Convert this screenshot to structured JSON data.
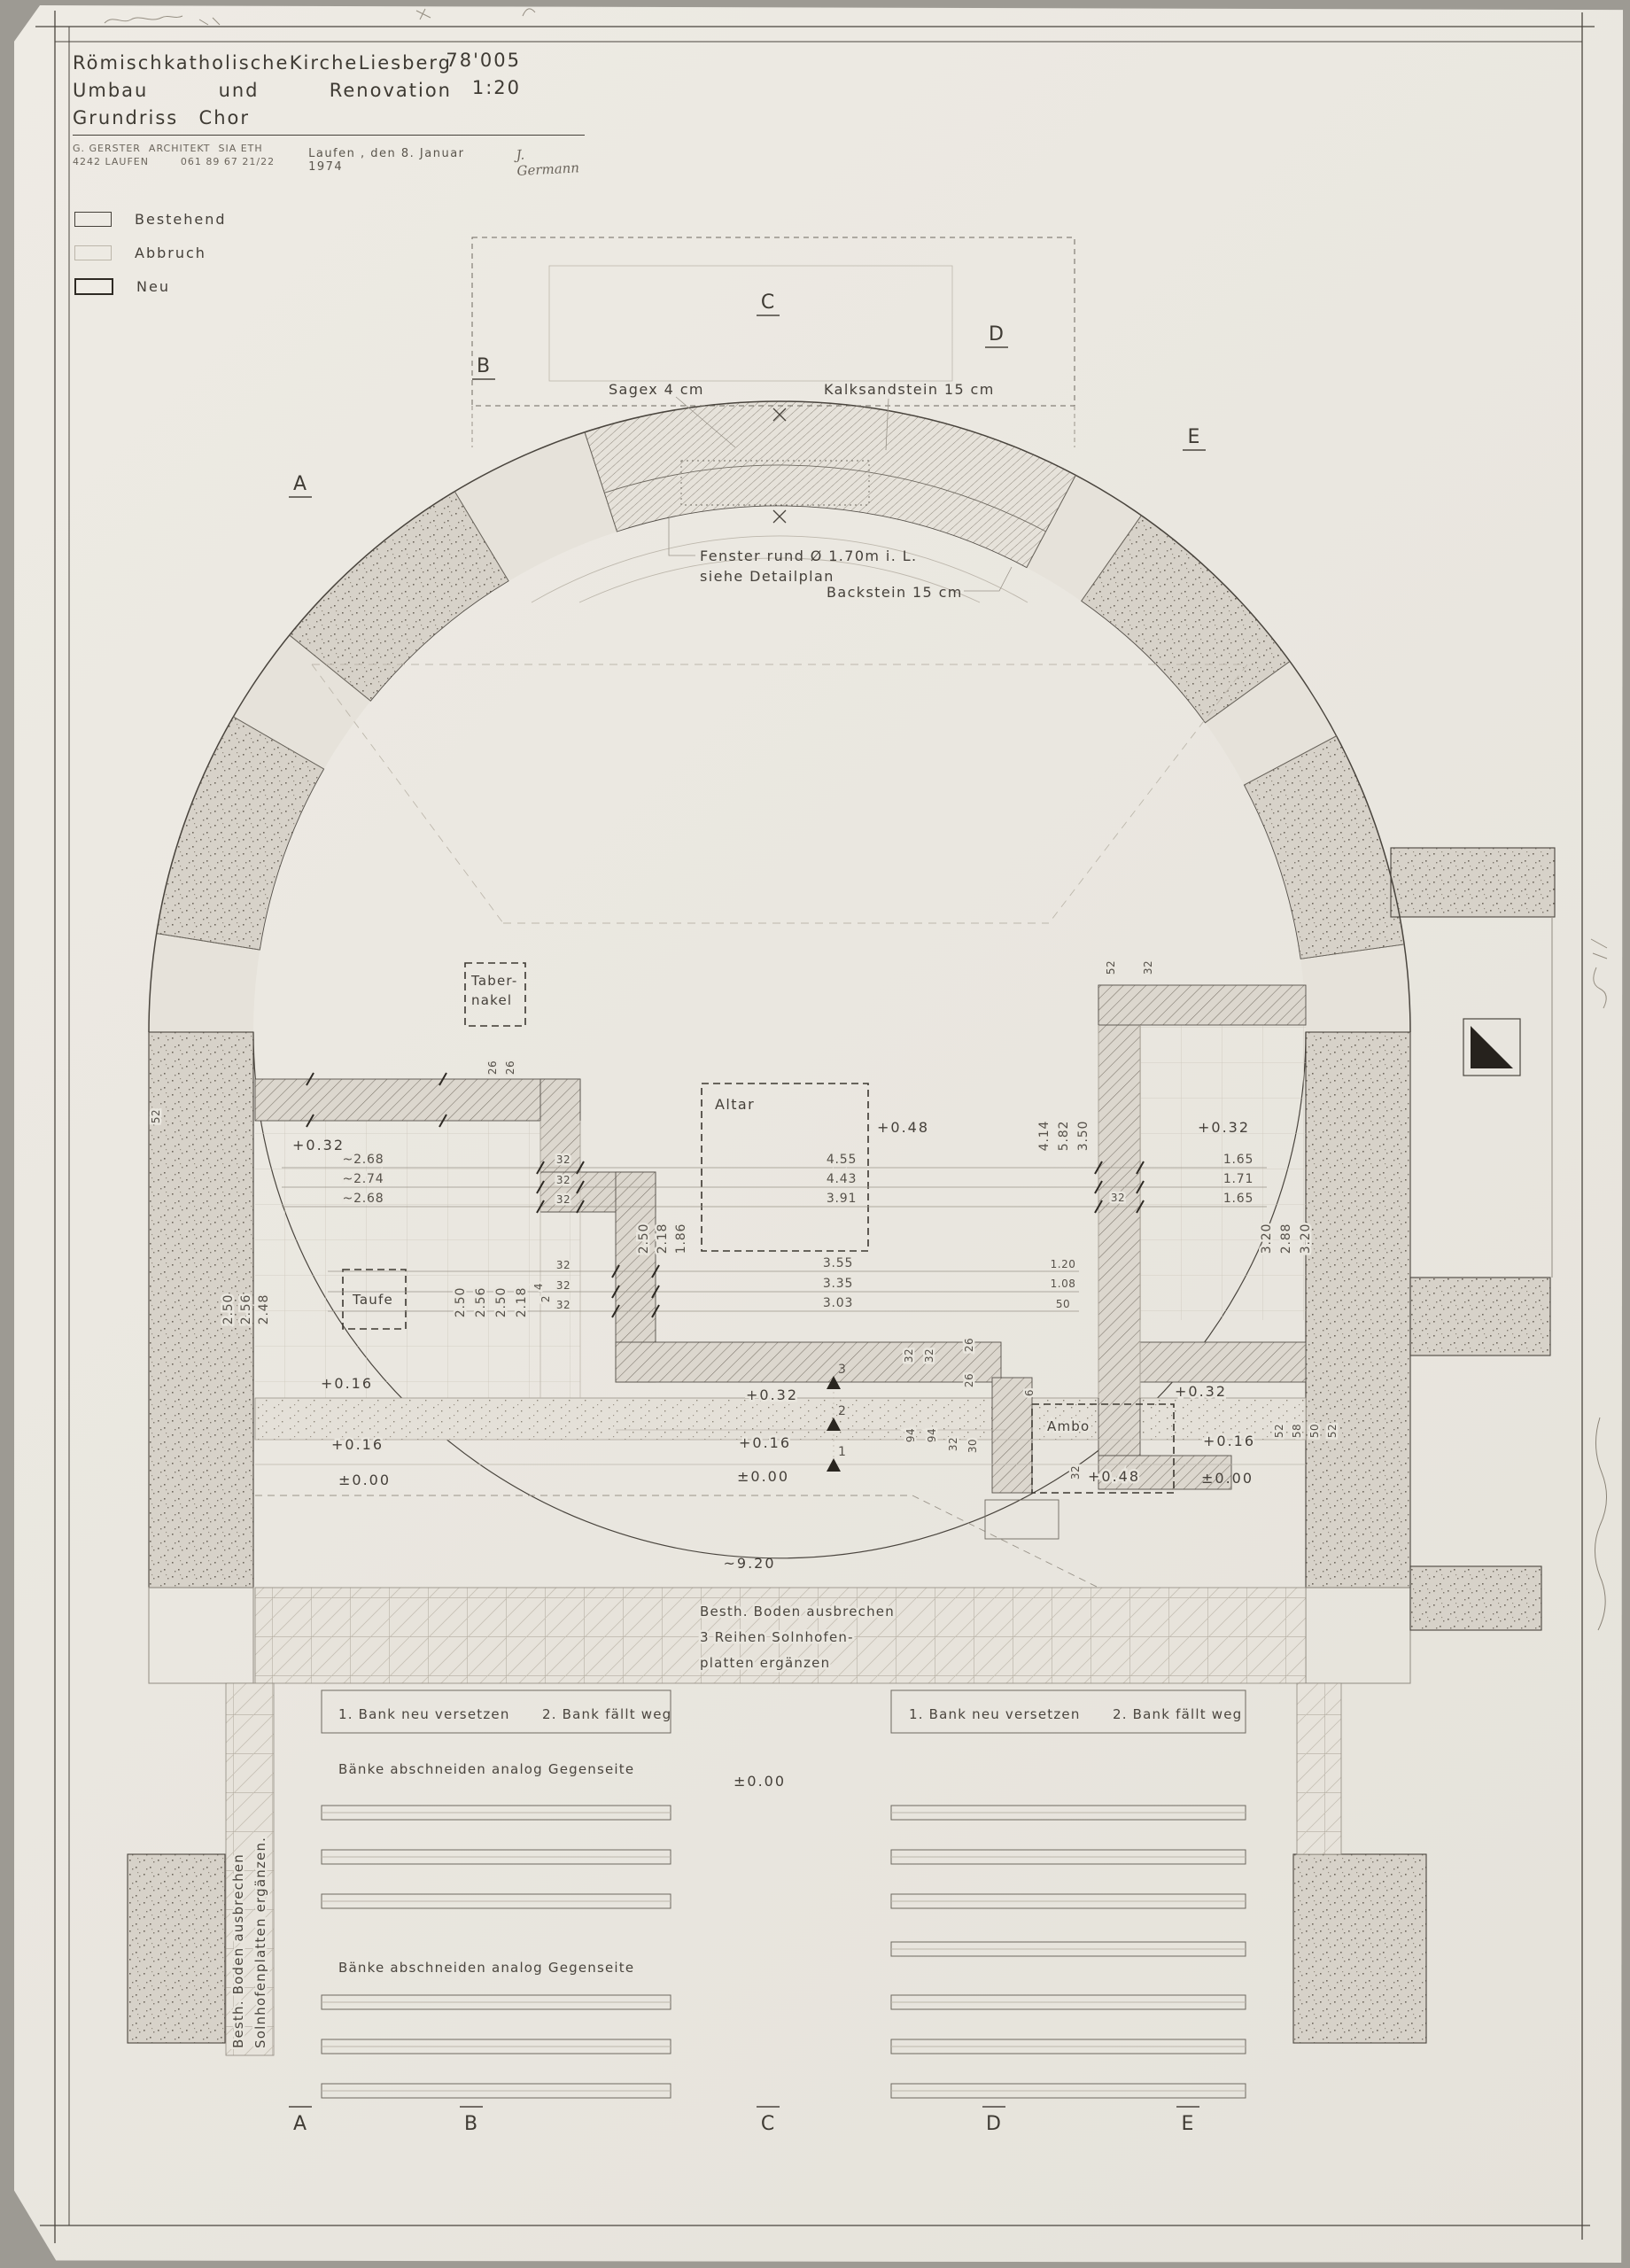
{
  "title_block": {
    "line1_w1": "Römisch",
    "line1_w2": "katholische",
    "line1_w3": "Kirche",
    "line1_w4": "Liesberg",
    "line2_w1": "Umbau",
    "line2_w2": "und",
    "line2_w3": "Renovation",
    "project_number": "78'005",
    "line3_w1": "Grundriss",
    "line3_w2": "Chor",
    "scale": "1:20",
    "architect_line1": "G. GERSTER  ARCHITEKT  SIA ETH",
    "architect_line2": "4242 LAUFEN        061 89 67 21/22",
    "date": "Laufen , den  8. Januar  1974",
    "signature": "J. Germann"
  },
  "legend": {
    "existing": "Bestehend",
    "demolition": "Abbruch",
    "new": "Neu"
  },
  "window_labels": {
    "sagex": "Sagex   4 cm",
    "kalksandstein": "Kalksandstein   15 cm",
    "fenster1": "Fenster  rund   Ø 1.70m  i. L.",
    "fenster2": "siehe  Detailplan",
    "backstein": "Backstein   15 cm"
  },
  "rooms": {
    "tabernakel1": "Taber-",
    "tabernakel2": "nakel",
    "altar": "Altar",
    "taufe": "Taufe",
    "ambo": "Ambo"
  },
  "levels": {
    "l032": "+0.32",
    "l048": "+0.48",
    "l016": "+0.16",
    "l000": "±0.00",
    "depth": "~9.20"
  },
  "dims": {
    "d1": [
      [
        "~2.68",
        "4.55",
        "1.65"
      ],
      [
        "~2.74",
        "4.43",
        "1.71"
      ],
      [
        "~2.68",
        "3.91",
        "1.65"
      ]
    ],
    "d2": [
      [
        "3.55",
        "1.20"
      ],
      [
        "3.35",
        "1.08"
      ],
      [
        "3.03",
        "50"
      ]
    ],
    "left_col": [
      "2.50",
      "2.56",
      "2.48"
    ],
    "taufe_col": [
      "2.50",
      "2.56",
      "2.50",
      "2.18"
    ],
    "center_col": [
      "2.50",
      "2.18",
      "1.86"
    ],
    "right_col": [
      "4.14",
      "5.82",
      "3.50"
    ],
    "far_right_col": [
      "3.20",
      "2.88",
      "3.20"
    ],
    "wall_col": [
      "52",
      "58",
      "50",
      "52"
    ],
    "s32": "32",
    "s26": "26",
    "s94": "94",
    "s30": "30",
    "s6": "6",
    "s52": "52",
    "s4": "4",
    "s2": "2"
  },
  "steps": [
    "3",
    "2",
    "1"
  ],
  "floor_notes": {
    "line1": "Besth.  Boden  ausbrechen",
    "line2": "3  Reihen  Solnhofen-",
    "line3": "platten   ergänzen",
    "vert1": "Besth.  Boden  ausbrechen",
    "vert2": "Solnhofenplatten  ergänzen."
  },
  "bench_notes": {
    "note1a": "1. Bank  neu  versetzen",
    "note1b": "2. Bank  fällt  weg",
    "note2": "Bänke  abschneiden  analog  Gegenseite"
  },
  "sections": {
    "a": "A",
    "b": "B",
    "c": "C",
    "d": "D",
    "e": "E"
  },
  "colors": {
    "paper": "#ebe8e1",
    "line": "#4a453e",
    "wall_fill": "#d8d3ca",
    "hatch": "#7d766c",
    "black": "#26221d"
  }
}
